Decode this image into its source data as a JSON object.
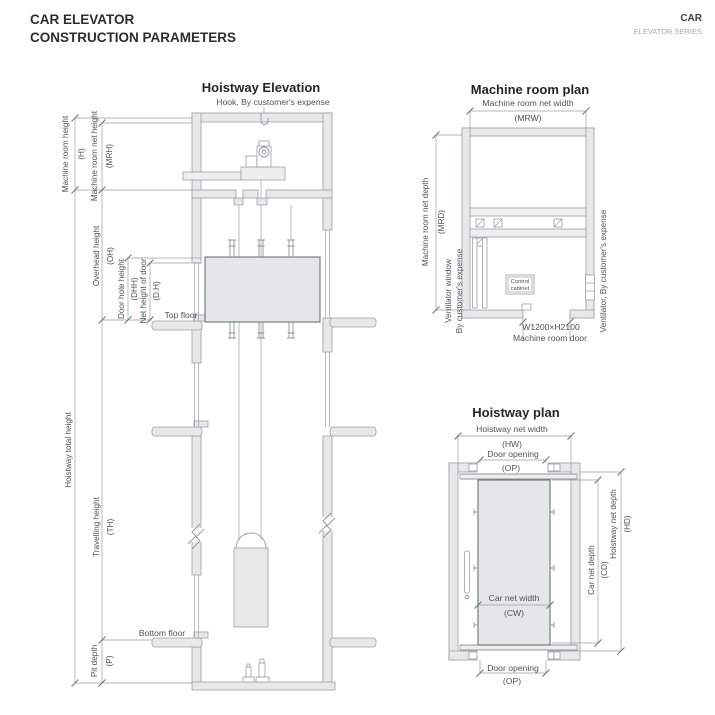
{
  "header": {
    "title_line1": "CAR ELEVATOR",
    "title_line2": "CONSTRUCTION PARAMETERS",
    "brand": "CAR",
    "series": "ELEVATOR SERIES"
  },
  "elevation": {
    "title": "Hoistway Elevation",
    "hook_note": "Hook, By customer's expense",
    "dims": {
      "machine_room_height": "Machine room height",
      "machine_room_height_sym": "(H)",
      "machine_room_net_height": "Machine room net height",
      "machine_room_net_height_sym": "(MRH)",
      "overhead_height": "Overhead height",
      "overhead_height_sym": "(OH)",
      "door_hole_height": "Door hole height",
      "door_hole_height_sym": "(DHH)",
      "net_height_of_door": "Net height of door",
      "net_height_of_door_sym": "(D.H)",
      "hoistway_total_height": "Hoistway total height",
      "travelling_height": "Travelling height",
      "travelling_height_sym": "(TH)",
      "pit_depth": "Pit depth",
      "pit_depth_sym": "(P)"
    },
    "floors": {
      "top": "Top floor",
      "bottom": "Bottom floor"
    }
  },
  "machine_room_plan": {
    "title": "Machine room plan",
    "dims": {
      "net_width": "Machine room net width",
      "net_width_sym": "(MRW)",
      "net_depth": "Machine room net depth",
      "net_depth_sym": "(MRD)",
      "door_size": "W1200×H2100",
      "door_name": "Machine room door"
    },
    "notes": {
      "ventilator_window_line1": "Ventilator window",
      "ventilator_window_line2": "By customer's expense",
      "ventilator_right": "Ventilator, By customer's expense",
      "control_cabinet_line1": "Control",
      "control_cabinet_line2": "cabinet"
    }
  },
  "hoistway_plan": {
    "title": "Hoistway plan",
    "dims": {
      "net_width": "Hoistway net width",
      "net_width_sym": "(HW)",
      "net_depth": "Hoistway net depth",
      "net_depth_sym": "(HD)",
      "door_opening_top": "Door opening",
      "door_opening_top_sym": "(OP)",
      "door_opening_bottom": "Door opening",
      "door_opening_bottom_sym": "(OP)",
      "car_net_width": "Car net width",
      "car_net_width_sym": "(CW)",
      "car_net_depth": "Car net depth",
      "car_net_depth_sym": "(CD)"
    }
  },
  "colors": {
    "wall_fill": "#e7e9e9",
    "line_gray": "#8f9696",
    "text_gray": "#4d5353",
    "title_dark": "#222626"
  }
}
